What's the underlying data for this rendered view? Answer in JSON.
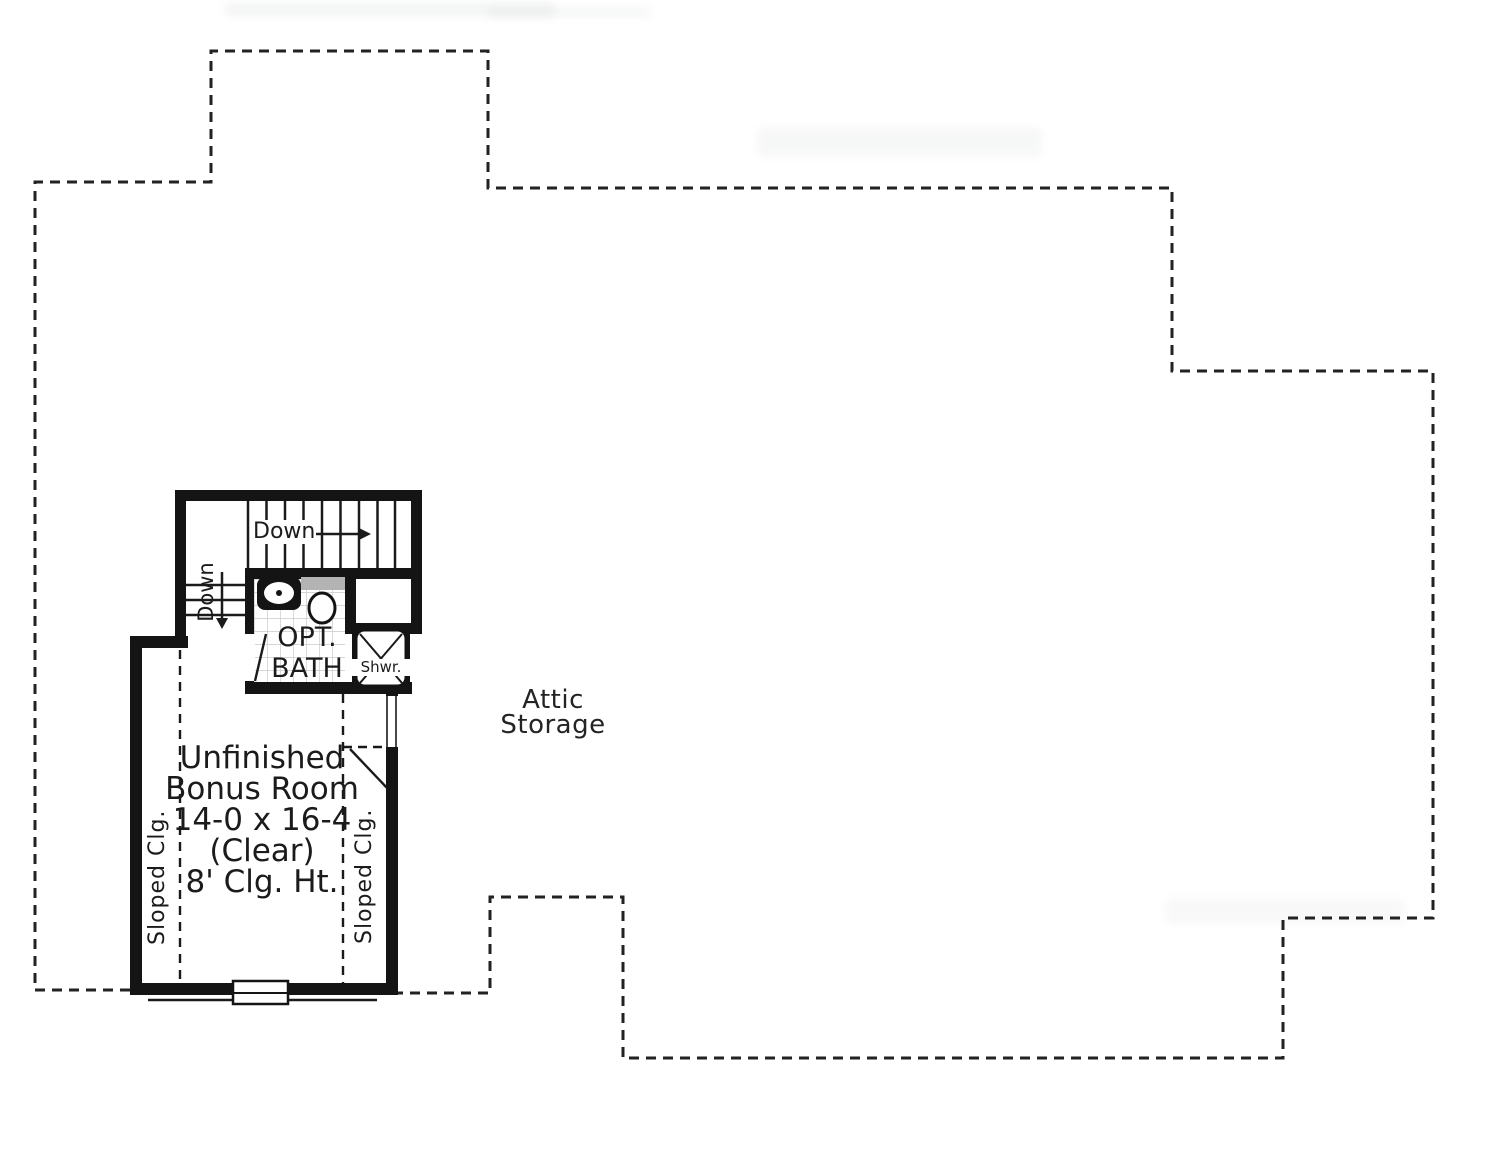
{
  "plan_type": "attic / second floor plan",
  "colors": {
    "background": "#ffffff",
    "walls": "#141414",
    "boundary_dashed": "#222222",
    "thin_lines": "#1a1a1a",
    "text": "#1b1b1b",
    "counter": "#b3b3b3",
    "tile_grid": "#c9c9c9"
  },
  "labels": {
    "attic": {
      "line1": "Attic",
      "line2": "Storage"
    },
    "bonus_room": {
      "title1": "Unfinished",
      "title2": "Bonus Room",
      "dims": "14-0 x 16-4",
      "clear": "(Clear)",
      "ceiling": "8' Clg. Ht."
    },
    "opt_bath": {
      "line1": "OPT.",
      "line2": "BATH"
    },
    "shower": "Shwr.",
    "stairs_down": "Down",
    "winder_down": "Down",
    "sloped_ceiling_left": "Sloped Clg.",
    "sloped_ceiling_right": "Sloped Clg."
  },
  "rooms": [
    {
      "name": "Attic Storage"
    },
    {
      "name": "Unfinished Bonus Room",
      "size": "14-0 x 16-4 (Clear)",
      "ceiling_height": "8' Clg. Ht."
    },
    {
      "name": "Opt. Bath"
    }
  ]
}
